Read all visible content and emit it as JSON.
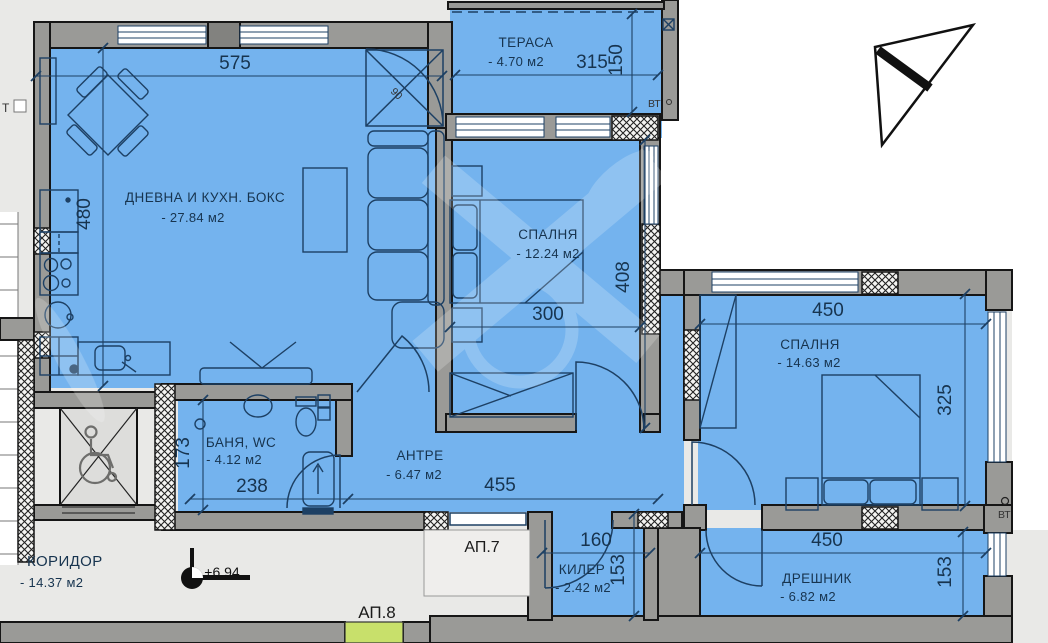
{
  "colors": {
    "interior": "#74b3ee",
    "walls": "#9a9a97",
    "background": "#e9e9e7",
    "exterior": "#ffffff",
    "entrance_highlight": "#c8e06b",
    "linework": "#1d4064"
  },
  "rooms": {
    "living": {
      "name": "ДНЕВНА И КУХН. БОКС",
      "area": "- 27.84 м2"
    },
    "terrace": {
      "name": "ТЕРАСА",
      "area": "- 4.70 м2"
    },
    "bedroom1": {
      "name": "СПАЛНЯ",
      "area": "- 12.24 м2"
    },
    "bedroom2": {
      "name": "СПАЛНЯ",
      "area": "- 14.63 м2"
    },
    "bath": {
      "name": "БАНЯ, WC",
      "area": "- 4.12 м2"
    },
    "hall": {
      "name": "АНТРЕ",
      "area": "- 6.47 м2"
    },
    "corridor": {
      "name": "КОРИДОР",
      "area": "- 14.37 м2"
    },
    "closet": {
      "name": "КИЛЕР",
      "area": "- 2.42 м2"
    },
    "walkin": {
      "name": "ДРЕШНИК",
      "area": "- 6.82 м2"
    }
  },
  "dimensions_cm": {
    "living_width": "575",
    "living_height": "480",
    "terrace_width": "315",
    "terrace_height": "150",
    "bedroom1_width": "300",
    "bedroom1_height": "408",
    "bedroom2_width": "450",
    "bedroom2_height": "325",
    "bath_height": "173",
    "bath_width": "238",
    "hall_width": "455",
    "closet_width": "160",
    "closet_height": "153",
    "walkin_width": "450",
    "walkin_height": "153"
  },
  "annotations": {
    "apartment_7": "АП.7",
    "apartment_8": "АП.8",
    "floor_level": "+6.94",
    "vt_terrace": "ВТ",
    "vt_bedroom2": "ВТ",
    "stair_label": "Т",
    "terrace_door_width": "90"
  }
}
